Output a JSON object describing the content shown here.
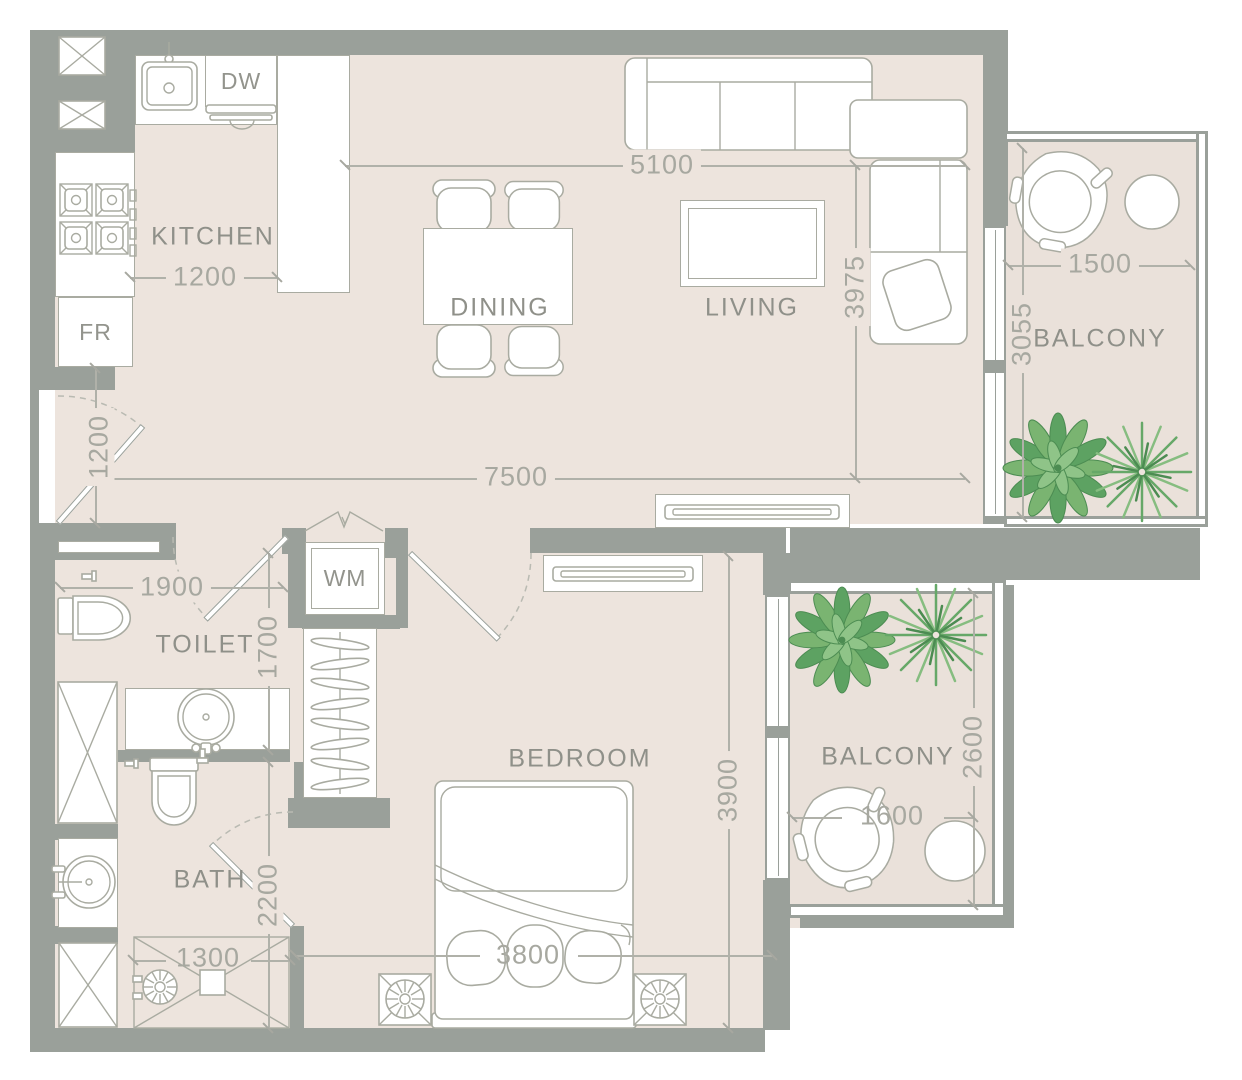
{
  "rooms": {
    "kitchen": "KITCHEN",
    "dining": "DINING",
    "living": "LIVING",
    "toilet": "TOILET",
    "bath": "BATH",
    "bedroom": "BEDROOM",
    "balcony_top": "BALCONY",
    "balcony_bottom": "BALCONY"
  },
  "appliances": {
    "dishwasher": "DW",
    "fridge": "FR",
    "washing_machine": "WM"
  },
  "dimensions": {
    "kitchen_counter": "1200",
    "living_width": "5100",
    "living_depth": "3975",
    "overall_width": "7500",
    "entry_opening": "1200",
    "toilet_width": "1900",
    "toilet_depth": "1700",
    "bath_depth": "2200",
    "shower_width": "1300",
    "bedroom_width": "3800",
    "bedroom_depth": "3900",
    "balcony_top_width": "1500",
    "balcony_top_depth": "3055",
    "balcony_bottom_width": "1600",
    "balcony_bottom_depth": "2600"
  },
  "colors": {
    "wall": "#9aa09a",
    "floor": "#ede4dd",
    "balcony_floor": "#eae1da",
    "furniture_line": "#a9aba1",
    "dimension_text": "#a7a8a0",
    "label_text": "#8f9089",
    "plant_green": "#6cb26d",
    "palm_green": "#5fa963"
  }
}
